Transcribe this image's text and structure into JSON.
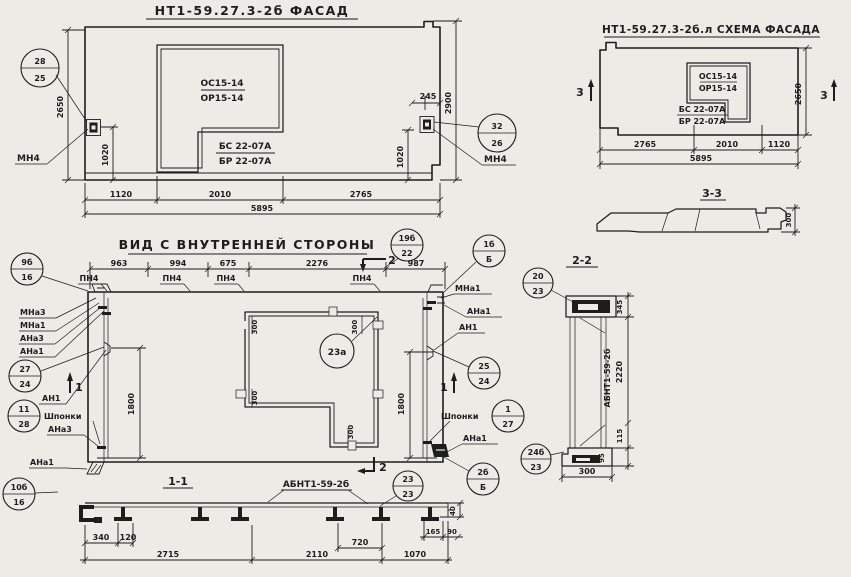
{
  "colors": {
    "paper": "#ECEBE5",
    "ink": "#1d1d1d"
  },
  "facade": {
    "title": "НТ1-59.27.3-2б ФАСАД",
    "window_top": "ОС15-14",
    "window_bot": "ОР15-14",
    "door_top": "БС 22-07А",
    "door_bot": "БР 22-07А",
    "d1120": "1120",
    "d2010": "2010",
    "d2765": "2765",
    "d5895": "5895",
    "d2650": "2650",
    "d2900": "2900",
    "d245": "245",
    "d1020": "1020",
    "co_left_top": "28",
    "co_left_bot": "25",
    "co_right_top": "32",
    "co_right_bot": "26",
    "anchor_label": "МН4"
  },
  "scheme": {
    "title": "НТ1-59.27.3-2б.л СХЕМА ФАСАДА",
    "window_top": "ОС15-14",
    "window_bot": "ОР15-14",
    "door_top": "БС 22-07А",
    "door_bot": "БР 22-07А",
    "d2765": "2765",
    "d2010": "2010",
    "d1120": "1120",
    "d5895": "5895",
    "d2650": "2650",
    "marker": "3"
  },
  "sec33": {
    "title": "3-3",
    "d300": "300"
  },
  "inner": {
    "title": "ВИД С ВНУТРЕННЕЙ СТОРОНЫ",
    "d963": "963",
    "d994": "994",
    "d675": "675",
    "d2276": "2276",
    "d987": "987",
    "pn4": "ПН4",
    "d1800": "1800",
    "d300": "300",
    "marker1": "1",
    "marker2": "2",
    "lbl_mna3": "МНа3",
    "lbl_mna1": "МНа1",
    "lbl_ana3": "АНа3",
    "lbl_ana1": "АНа1",
    "lbl_an1": "АН1",
    "lbl_shponki": "Шпонки",
    "co_9b_top": "9б",
    "co_9b_bot": "16",
    "co_19b_top": "19б",
    "co_19b_bot": "22",
    "co_1b_top": "1б",
    "co_1b_bot": "Б",
    "co_27_top": "27",
    "co_27_bot": "24",
    "co_11_top": "11",
    "co_11_bot": "28",
    "co_23a": "23а",
    "co_25_top": "25",
    "co_25_bot": "24",
    "co_1_top": "1",
    "co_1_bot": "27",
    "co_2b_top": "2б",
    "co_2b_bot": "Б",
    "co_23_top": "23",
    "co_23_bot": "23",
    "co_10b_top": "10б",
    "co_10b_bot": "16"
  },
  "sec11": {
    "title": "1-1",
    "label": "АБНТ1-59-2б",
    "d340": "340",
    "d120": "120",
    "d2715": "2715",
    "d2110": "2110",
    "d720": "720",
    "d1070": "1070",
    "d165": "165",
    "d90": "90",
    "d40": "40"
  },
  "sec22": {
    "title": "2-2",
    "label": "АБНТ1-59-2б",
    "d345": "345",
    "d2220": "2220",
    "d115": "115",
    "d95": "95",
    "d300": "300",
    "co_20_top": "20",
    "co_20_bot": "23",
    "co_24b_top": "24б",
    "co_24b_bot": "23"
  }
}
